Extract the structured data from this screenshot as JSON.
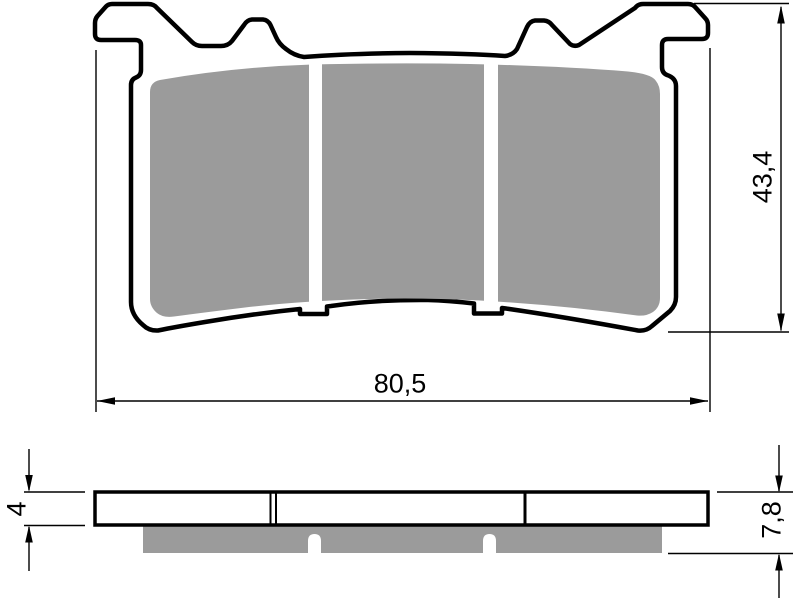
{
  "drawing": {
    "dimensions": {
      "width": "80,5",
      "height": "43,4",
      "plate_thickness": "4",
      "total_thickness": "7,8"
    },
    "colors": {
      "line": "#000000",
      "friction": "#9b9b9b",
      "plate_fill": "#ffffff",
      "background": "#ffffff"
    }
  }
}
